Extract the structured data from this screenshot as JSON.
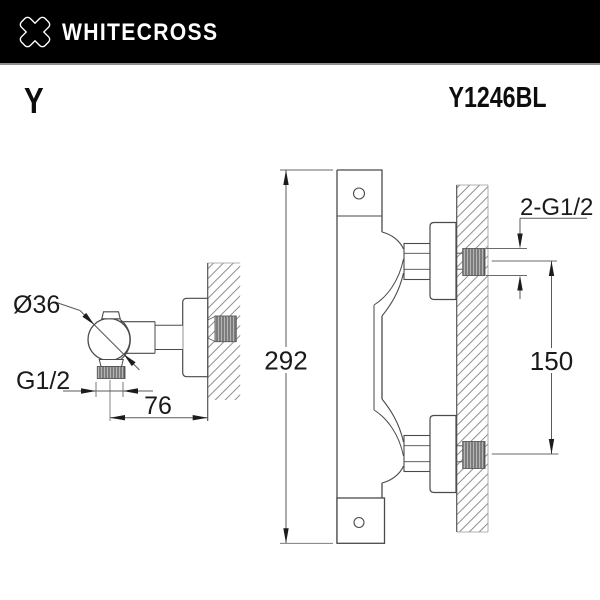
{
  "header": {
    "brand": "WHITECROSS",
    "logo_icon": "x-cross-logo",
    "background": "#000000",
    "text_color": "#ffffff"
  },
  "product": {
    "series": "Y",
    "model": "Y1246BL"
  },
  "drawing": {
    "line_color": "#4a4a4a",
    "hatch_color": "#8a8a8a",
    "side_view": {
      "dim_diameter": "Ø36",
      "dim_outlet_thread": "G1/2",
      "dim_wall_distance": "76"
    },
    "front_view": {
      "dim_height": "292",
      "dim_inlet_spacing": "150",
      "dim_wall_threads": "2-G1/2"
    }
  }
}
